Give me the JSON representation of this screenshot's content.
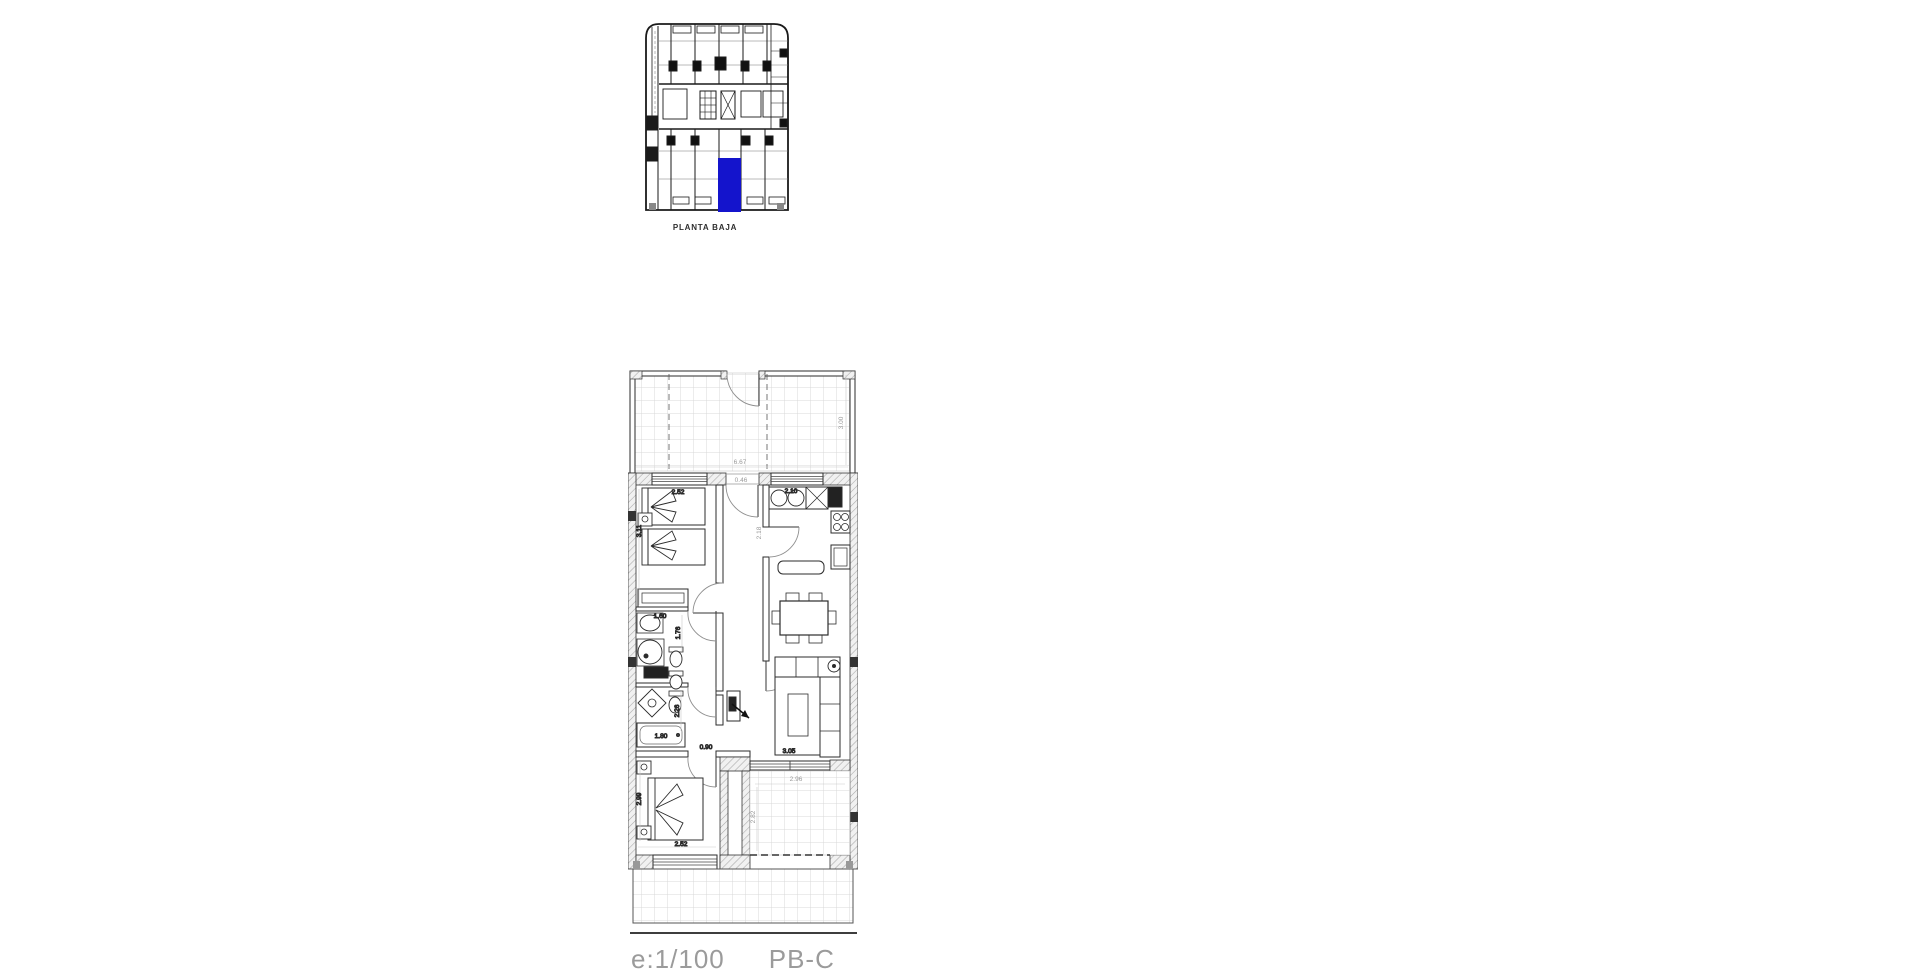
{
  "overview": {
    "caption": "PLANTA BAJA",
    "highlight_color": "#1414cc",
    "highlighted_unit": "PB-C"
  },
  "floor_plan": {
    "dimensions": {
      "terrace_width": "6.67",
      "terrace_depth": "3.00",
      "bedroom1_width": "2.52",
      "bedroom1_depth": "3.11",
      "entrance_width": "0.46",
      "kitchen_width": "2.10",
      "hall_depth": "2.18",
      "bath1_width": "1.60",
      "bath1_depth": "1.76",
      "bath2_depth": "2.26",
      "bathtub_length": "1.80",
      "passage_width": "0.90",
      "living_width": "3.05",
      "bedroom2_width": "2.52",
      "bedroom2_depth": "2.99",
      "patio_width": "2.96",
      "patio_depth": "2.82"
    }
  },
  "footer": {
    "scale": "e:1/100",
    "unit": "PB-C",
    "line_color": "#3d3d3d",
    "text_color": "#9b9b9b"
  }
}
